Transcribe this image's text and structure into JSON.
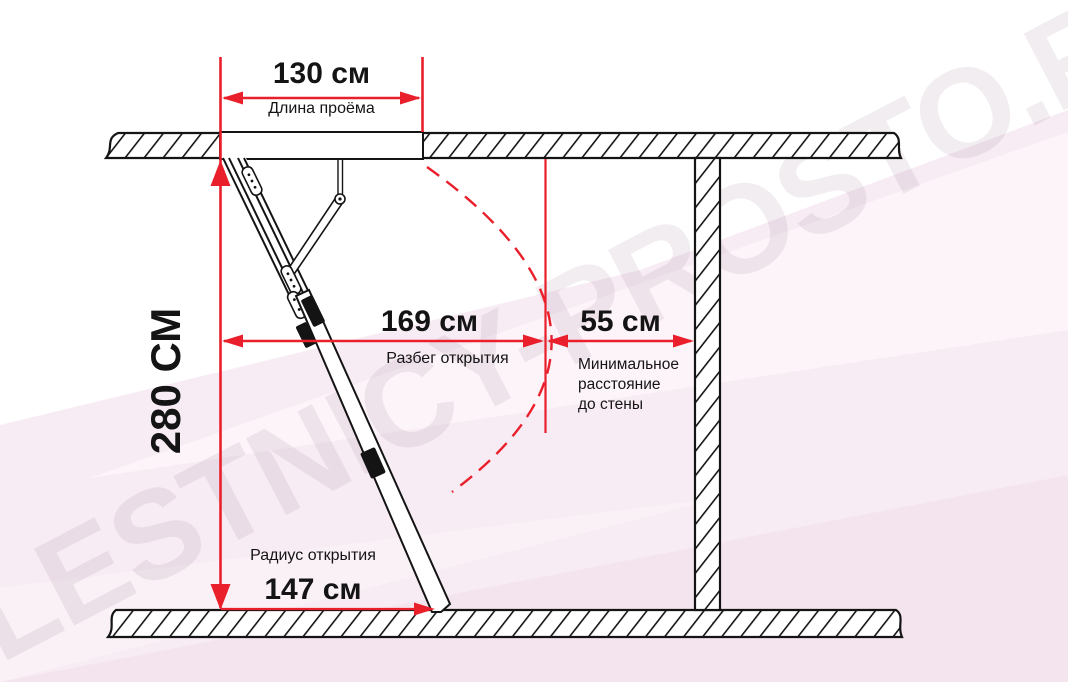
{
  "watermark": {
    "text": "LESTNICY-PROSTO.RU"
  },
  "colors": {
    "dimension_red": "#e9202b",
    "line_black": "#141414",
    "background_pink": "#f8ecf4",
    "watermark_tint": "#eadfe6"
  },
  "dims": {
    "opening_length": {
      "value": "130 см",
      "label": "Длина проёма"
    },
    "ceiling_height": {
      "value": "280 СМ"
    },
    "opening_run": {
      "value": "169 см",
      "label": "Разбег открытия"
    },
    "min_wall_distance": {
      "value": "55 см",
      "label_lines": [
        "Минимальное",
        "расстояние",
        "до стены"
      ]
    },
    "opening_radius": {
      "value": "147 см",
      "label": "Радиус открытия"
    }
  }
}
